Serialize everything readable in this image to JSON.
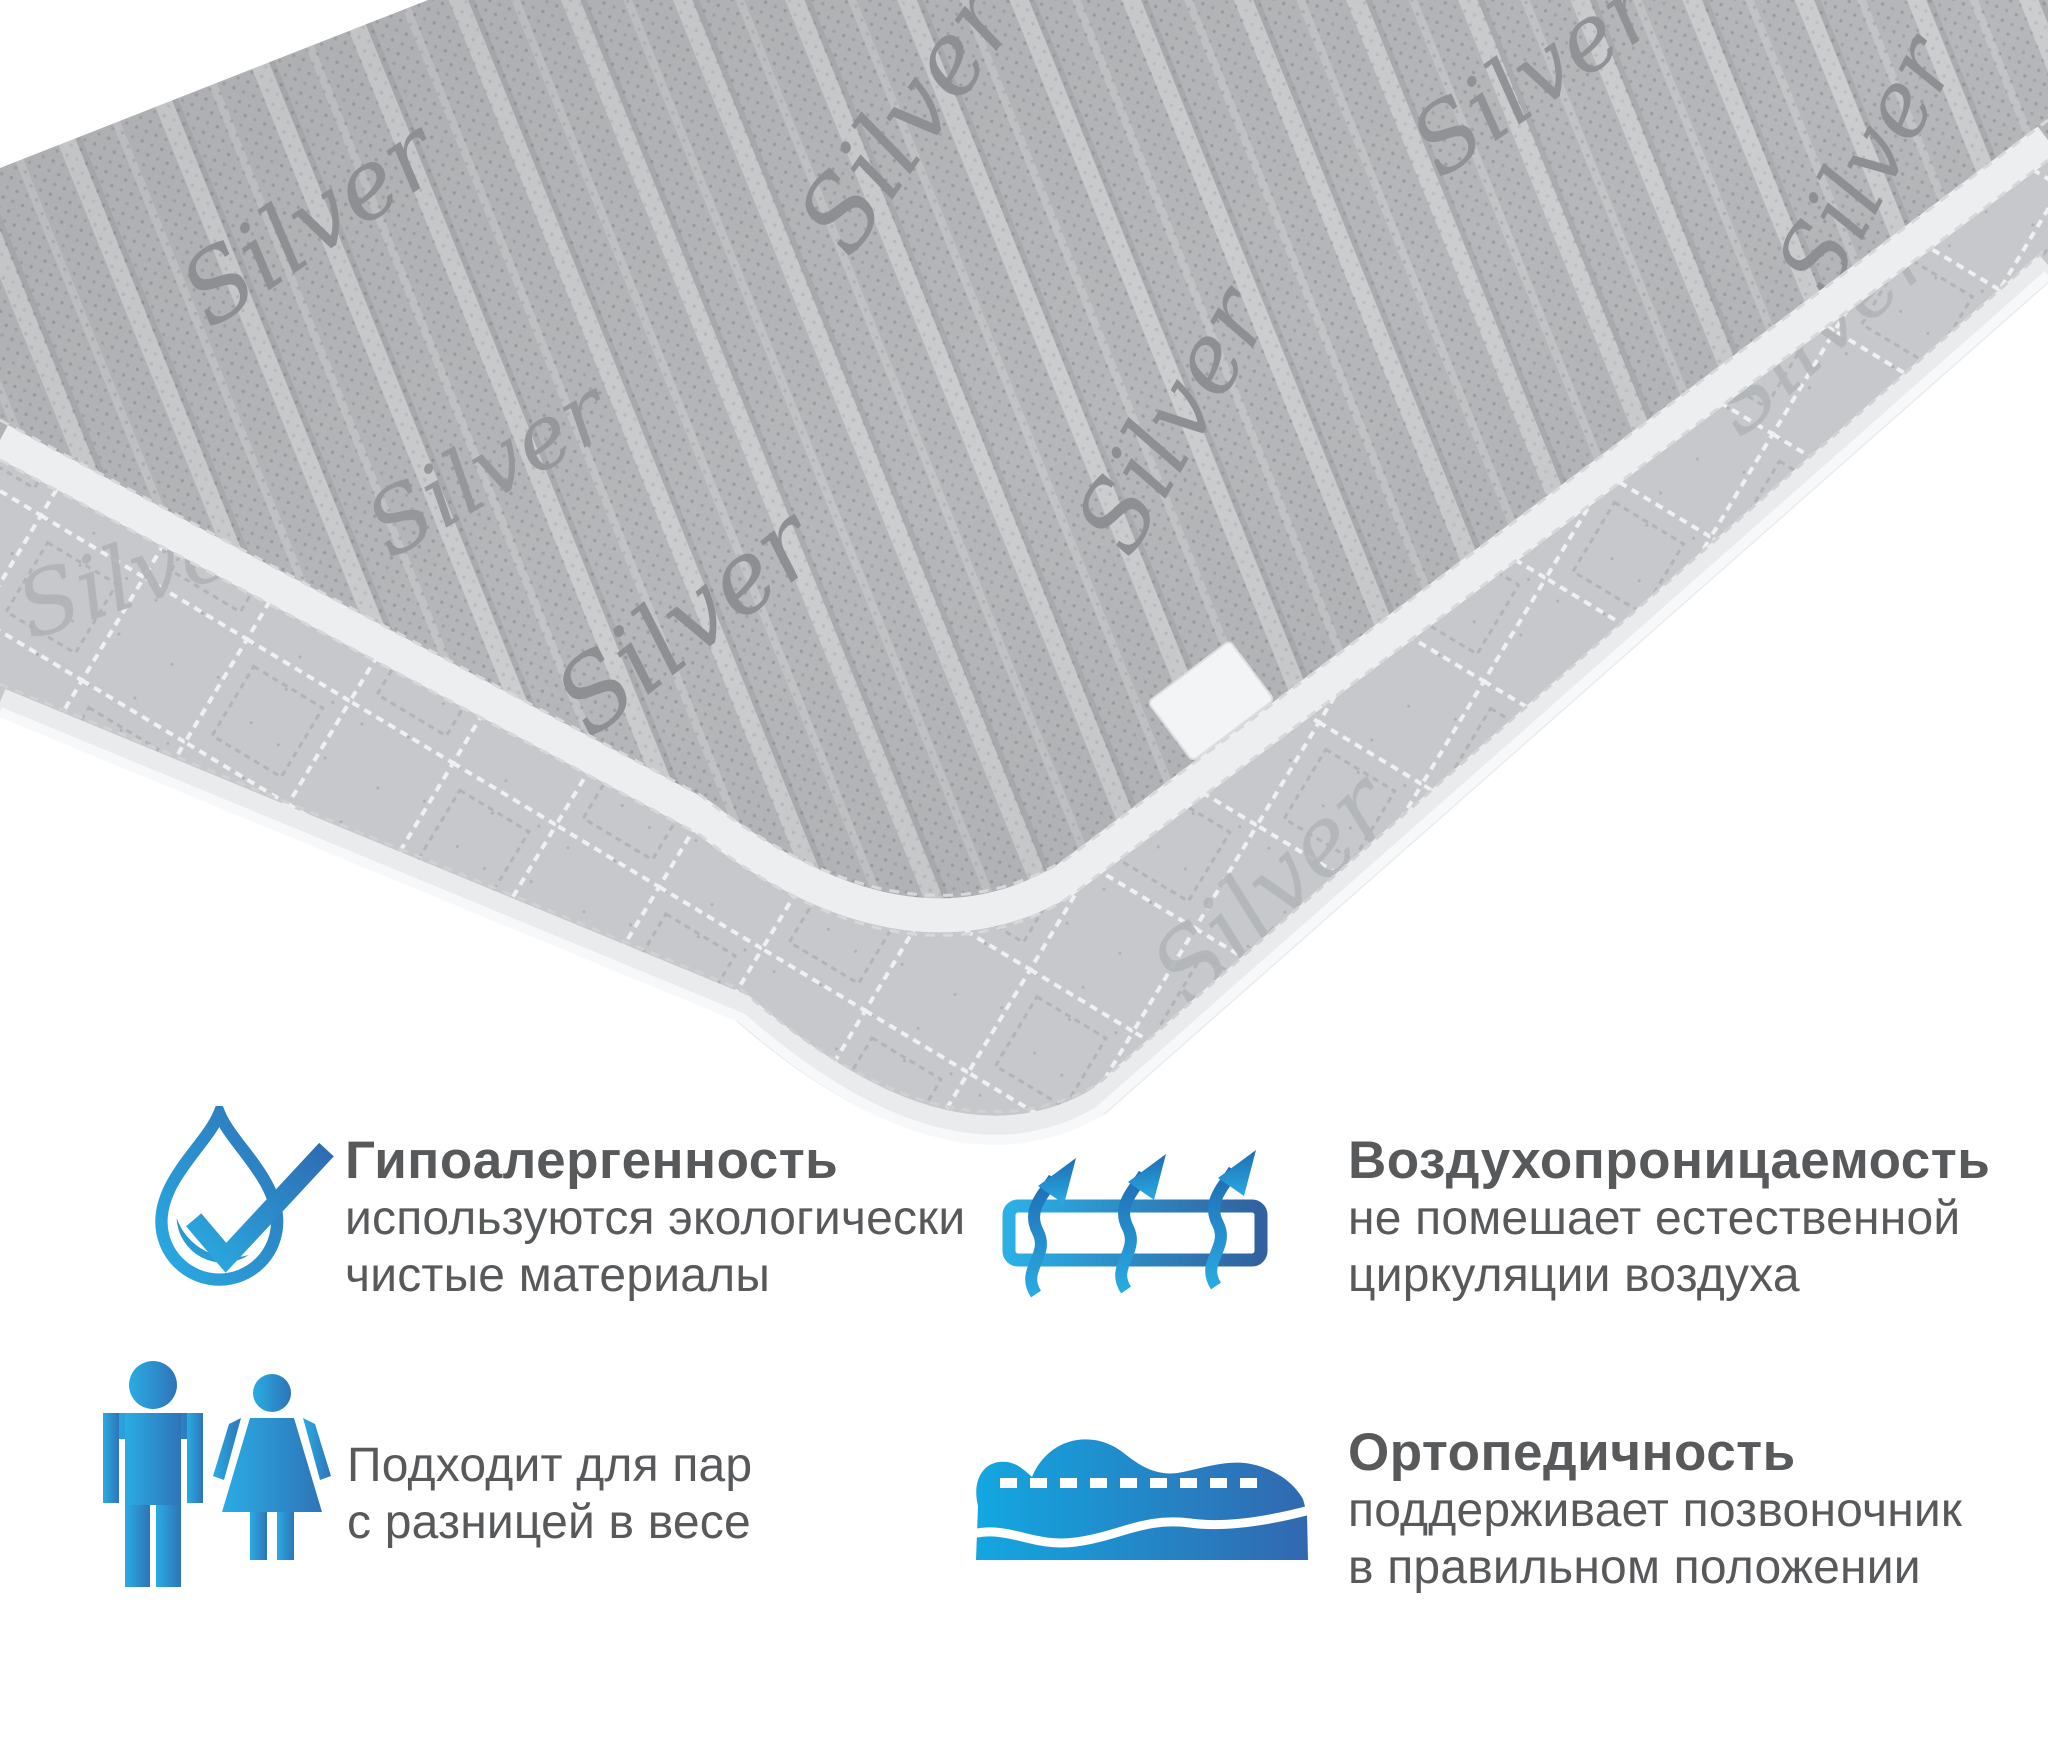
{
  "mattress": {
    "fabric_logo": "Silver",
    "description": "gray quilted mattress shown from corner perspective",
    "colors": {
      "top_fabric": "#b5b7ba",
      "top_dots": "#9b9da1",
      "side_fabric": "#c6c8cb",
      "piping": "#eceeef",
      "logo_text": "#8d8f92"
    },
    "tag": "blank-white-tag"
  },
  "features": {
    "hypoallergenic": {
      "icon": "water-drop-check-icon",
      "title": "Гипоалергенность",
      "line1": "используются экологически",
      "line2": "чистые материалы"
    },
    "breathability": {
      "icon": "airflow-arrows-icon",
      "title": "Воздухопроницаемость",
      "line1": "не помешает естественной",
      "line2": "циркуляции воздуха"
    },
    "couples": {
      "icon": "man-woman-icon",
      "line1": "Подходит для пар",
      "line2": "с разницей в весе"
    },
    "orthopedic": {
      "icon": "sleeping-person-icon",
      "title": "Ортопедичность",
      "line1": "поддерживает позвоночник",
      "line2": "в правильном положении"
    }
  },
  "palette": {
    "accent_blue_light": "#29abe2",
    "accent_blue_dark": "#2b6cb3",
    "text_color": "#58595b"
  }
}
